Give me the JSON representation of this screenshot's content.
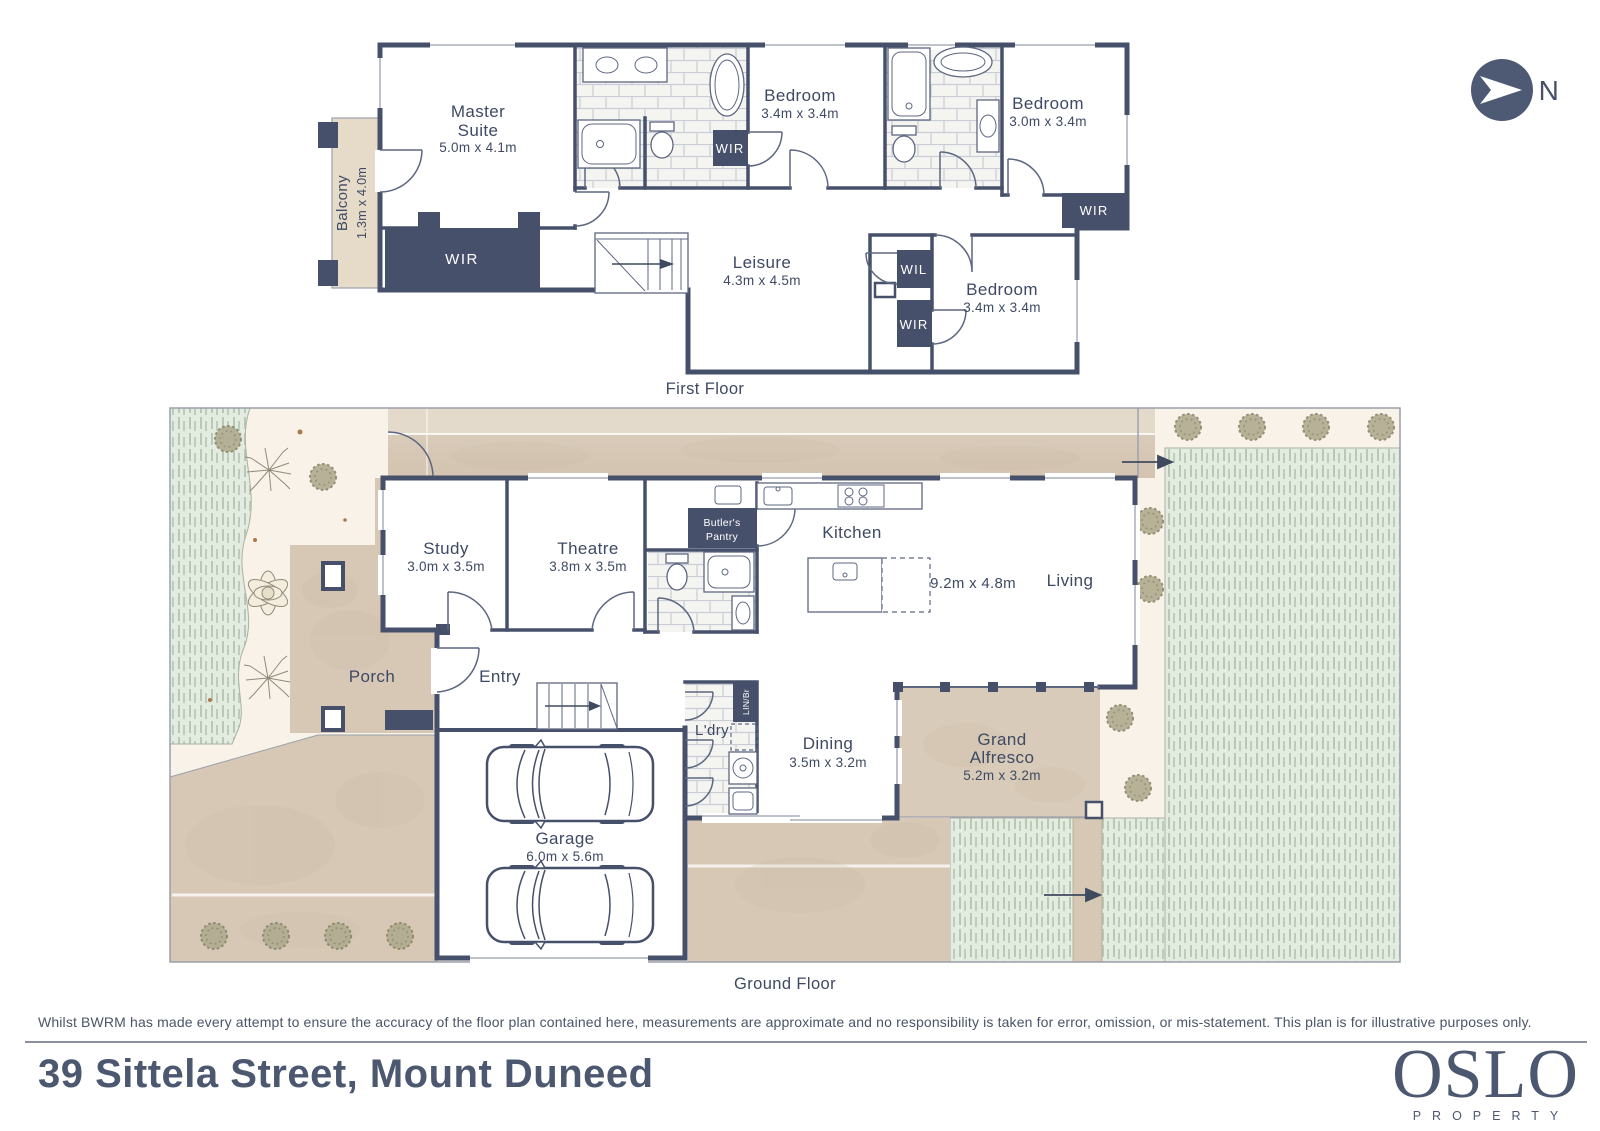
{
  "property": {
    "address": "39 Sittela Street, Mount Duneed"
  },
  "compass": {
    "label": "N"
  },
  "first_floor": {
    "caption": "First Floor",
    "master_suite": {
      "line1": "Master",
      "line2": "Suite",
      "dims": "5.0m x 4.1m"
    },
    "balcony": {
      "name": "Balcony",
      "dims": "1.3m x 4.0m"
    },
    "bedroom_2": {
      "name": "Bedroom",
      "dims": "3.4m x 3.4m"
    },
    "bedroom_3": {
      "name": "Bedroom",
      "dims": "3.0m x 3.4m"
    },
    "bedroom_4": {
      "name": "Bedroom",
      "dims": "3.4m x 3.4m"
    },
    "leisure": {
      "name": "Leisure",
      "dims": "4.3m x 4.5m"
    },
    "wir_master": "WIR",
    "wir_ensuite": "WIR",
    "wir_bedroom3": "WIR",
    "wil": "WIL",
    "wir_bedroom4": "WIR"
  },
  "ground_floor": {
    "caption": "Ground Floor",
    "study": {
      "name": "Study",
      "dims": "3.0m x 3.5m"
    },
    "theatre": {
      "name": "Theatre",
      "dims": "3.8m x 3.5m"
    },
    "butlers_pantry": {
      "line1": "Butler's",
      "line2": "Pantry"
    },
    "kitchen": {
      "name": "Kitchen"
    },
    "living": {
      "name": "Living"
    },
    "open_plan_dims": "9.2m x 4.8m",
    "porch": {
      "name": "Porch"
    },
    "entry": {
      "name": "Entry"
    },
    "laundry": {
      "name": "L'dry"
    },
    "linen_broom": "LIN/Br",
    "dining": {
      "name": "Dining",
      "dims": "3.5m x 3.2m"
    },
    "grand_alfresco": {
      "line1": "Grand",
      "line2": "Alfresco",
      "dims": "5.2m x 3.2m"
    },
    "garage": {
      "name": "Garage",
      "dims": "6.0m x 5.6m"
    }
  },
  "footer": {
    "disclaimer": "Whilst BWRM  has made every attempt to ensure the accuracy of the floor plan contained here, measurements are approximate and no responsibility is taken for error, omission, or mis-statement. This plan is for illustrative purposes only."
  },
  "brand": {
    "name": "OSLO",
    "tagline": "PROPERTY"
  },
  "colors": {
    "wall": "#46506a",
    "label_text": "#3e4a63",
    "paving": "#d7c8b6",
    "cream": "#f8f2e9",
    "grass": "#e4ece2",
    "brand_text": "#4c5870"
  }
}
